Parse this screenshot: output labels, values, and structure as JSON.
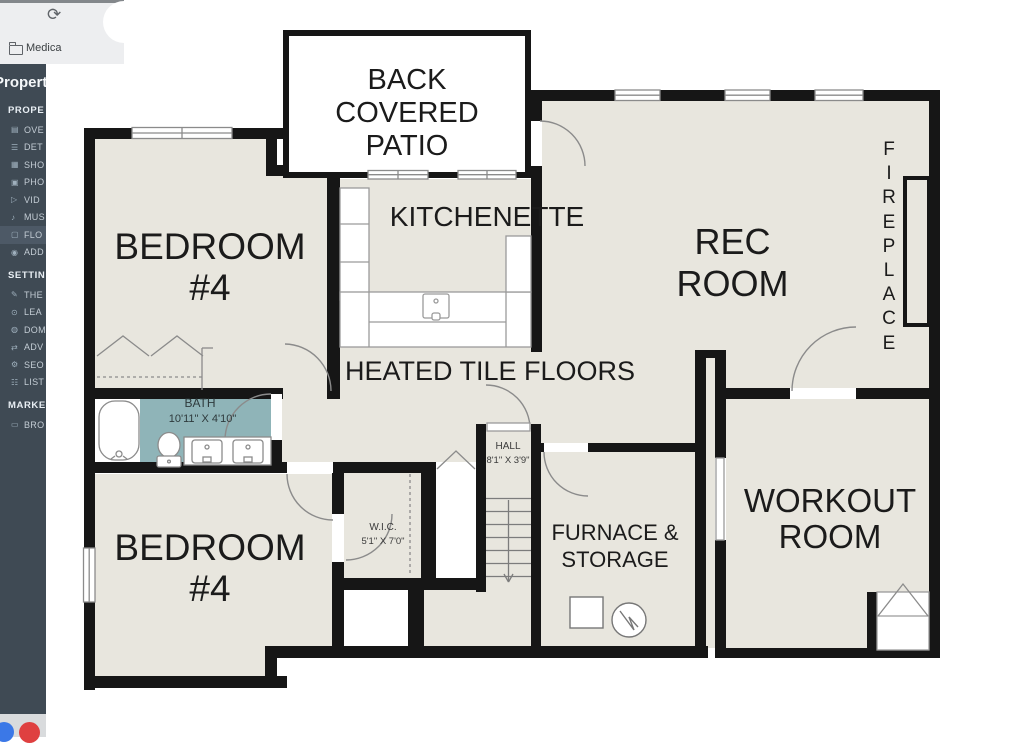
{
  "browser": {
    "reload_glyph": "⟳",
    "bookmark_label": "Medica"
  },
  "sidebar": {
    "title": "Property",
    "active_item": "FLO",
    "sections": [
      {
        "header": "PROPE",
        "items": [
          {
            "label": "OVE",
            "glyph": "▤"
          },
          {
            "label": "DET",
            "glyph": "☰"
          },
          {
            "label": "SHO",
            "glyph": "▦"
          },
          {
            "label": "PHO",
            "glyph": "▣"
          },
          {
            "label": "VID",
            "glyph": "▷"
          },
          {
            "label": "MUS",
            "glyph": "♪"
          },
          {
            "label": "FLO",
            "glyph": "▢"
          },
          {
            "label": "ADD",
            "glyph": "◉"
          }
        ]
      },
      {
        "header": "SETTIN",
        "items": [
          {
            "label": "THE",
            "glyph": "✎"
          },
          {
            "label": "LEA",
            "glyph": "⊙"
          },
          {
            "label": "DOM",
            "glyph": "◍"
          },
          {
            "label": "ADV",
            "glyph": "⇄"
          },
          {
            "label": "SEO",
            "glyph": "⚙"
          },
          {
            "label": "LIST",
            "glyph": "☷"
          }
        ]
      },
      {
        "header": "MARKE",
        "items": [
          {
            "label": "BRO",
            "glyph": "▭"
          }
        ]
      }
    ]
  },
  "floorplan": {
    "labels": {
      "patio": "BACK COVERED\nPATIO",
      "kitchenette": "KITCHENETTE",
      "rec_room": "REC\nROOM",
      "fireplace": "F\nI\nR\nE\nP\nL\nA\nC\nE",
      "bedroom_top": "BEDROOM\n#4",
      "bedroom_bottom": "BEDROOM\n#4",
      "heated_tile": "HEATED TILE FLOORS",
      "bath_name": "BATH",
      "bath_dims": "10'11\" X 4'10\"",
      "hall_name": "HALL",
      "hall_dims": "8'1\" X 3'9\"",
      "wic_name": "W.I.C.",
      "wic_dims": "5'1\" X 7'0\"",
      "furnace": "FURNACE &\nSTORAGE",
      "workout": "WORKOUT\nROOM"
    },
    "colors": {
      "floor": "#e8e6de",
      "wall": "#161616",
      "bath_floor": "#8fb4b8",
      "linework": "#8b8b8b"
    }
  },
  "dock": {
    "icon_colors": [
      "#3b78e7",
      "#df4040"
    ]
  }
}
